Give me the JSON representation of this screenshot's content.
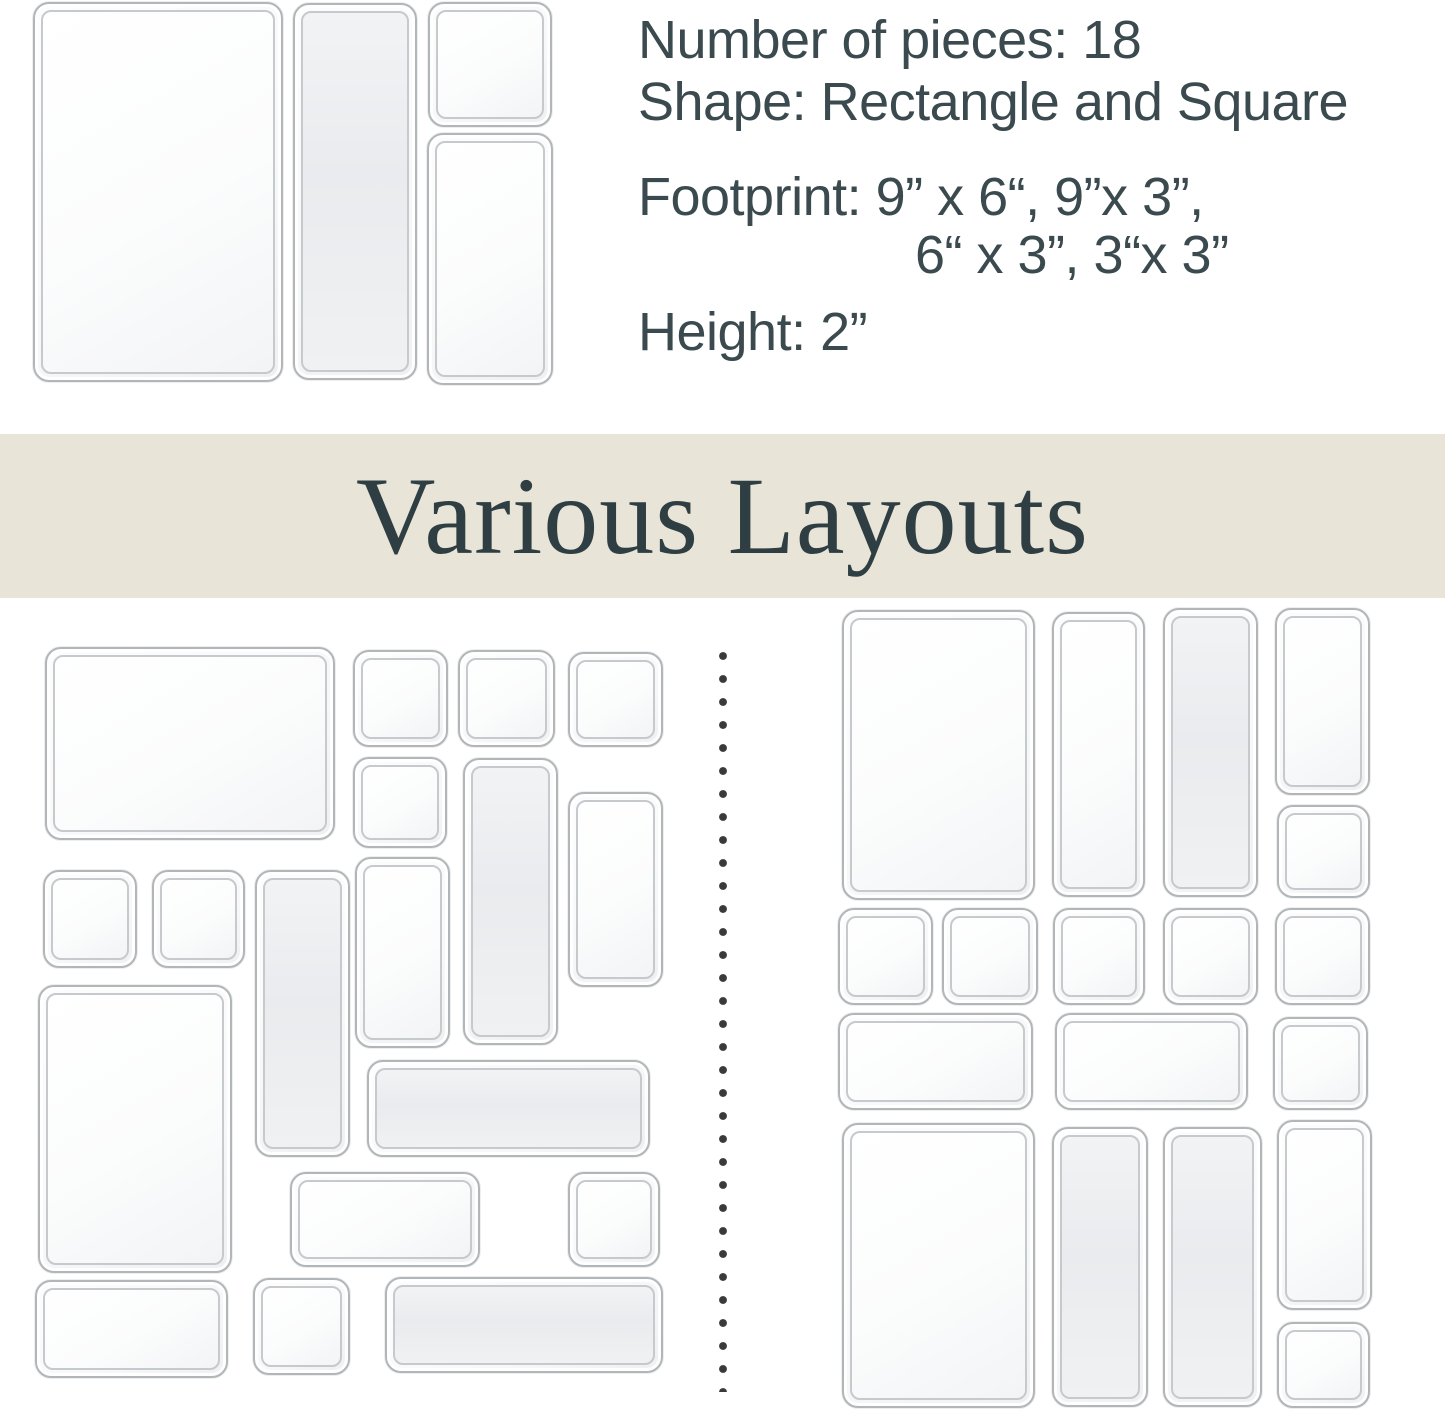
{
  "specs": {
    "number_of_pieces": "Number of pieces: 18",
    "shape": "Shape: Rectangle and Square",
    "footprint_line1": "Footprint: 9” x 6“, 9”x 3”,",
    "footprint_line2": "6“ x 3”, 3“x 3”",
    "height": "Height: 2”"
  },
  "banner": {
    "title": "Various Layouts"
  },
  "colors": {
    "page-bg": "#ffffff",
    "spec-text": "#3a4a4e",
    "banner-bg": "#e8e4d7",
    "banner-text": "#2e3e42",
    "tray-border": "#b2b6b9",
    "tray-inner-border": "#c6cacc",
    "divider-dot": "#3a3a3a"
  },
  "divider": {
    "dot_count": 33
  },
  "trays": {
    "photo": [
      {
        "size": "9x6",
        "x": 33,
        "y": 2,
        "w": 250,
        "h": 380,
        "shade": false
      },
      {
        "size": "9x3",
        "x": 293,
        "y": 3,
        "w": 124,
        "h": 377,
        "shade": true
      },
      {
        "size": "3x3",
        "x": 428,
        "y": 2,
        "w": 124,
        "h": 125,
        "shade": false
      },
      {
        "size": "6x3",
        "x": 427,
        "y": 133,
        "w": 126,
        "h": 252,
        "shade": false
      }
    ],
    "left_layout": [
      {
        "size": "9x6",
        "x": 45,
        "y": 647,
        "w": 290,
        "h": 193,
        "shade": false
      },
      {
        "size": "3x3",
        "x": 353,
        "y": 650,
        "w": 95,
        "h": 97,
        "shade": false
      },
      {
        "size": "3x3",
        "x": 458,
        "y": 650,
        "w": 97,
        "h": 97,
        "shade": false
      },
      {
        "size": "3x3",
        "x": 568,
        "y": 652,
        "w": 95,
        "h": 95,
        "shade": false
      },
      {
        "size": "3x3",
        "x": 353,
        "y": 757,
        "w": 94,
        "h": 91,
        "shade": false
      },
      {
        "size": "9x3",
        "x": 463,
        "y": 758,
        "w": 95,
        "h": 287,
        "shade": true
      },
      {
        "size": "6x3",
        "x": 568,
        "y": 792,
        "w": 95,
        "h": 195,
        "shade": false
      },
      {
        "size": "3x3",
        "x": 43,
        "y": 870,
        "w": 94,
        "h": 98,
        "shade": false
      },
      {
        "size": "3x3",
        "x": 152,
        "y": 870,
        "w": 93,
        "h": 98,
        "shade": false
      },
      {
        "size": "9x3",
        "x": 255,
        "y": 870,
        "w": 95,
        "h": 287,
        "shade": true
      },
      {
        "size": "6x3",
        "x": 355,
        "y": 857,
        "w": 95,
        "h": 191,
        "shade": false
      },
      {
        "size": "9x6",
        "x": 38,
        "y": 985,
        "w": 194,
        "h": 288,
        "shade": false
      },
      {
        "size": "9x3",
        "x": 367,
        "y": 1060,
        "w": 283,
        "h": 97,
        "shade": true
      },
      {
        "size": "6x3",
        "x": 290,
        "y": 1172,
        "w": 190,
        "h": 95,
        "shade": false
      },
      {
        "size": "3x3",
        "x": 568,
        "y": 1172,
        "w": 92,
        "h": 95,
        "shade": false
      },
      {
        "size": "6x3",
        "x": 35,
        "y": 1280,
        "w": 193,
        "h": 98,
        "shade": false
      },
      {
        "size": "3x3",
        "x": 253,
        "y": 1278,
        "w": 97,
        "h": 97,
        "shade": false
      },
      {
        "size": "9x3",
        "x": 385,
        "y": 1277,
        "w": 278,
        "h": 96,
        "shade": true
      }
    ],
    "right_layout": [
      {
        "size": "9x6",
        "x": 842,
        "y": 610,
        "w": 193,
        "h": 290,
        "shade": false
      },
      {
        "size": "3x3",
        "x": 838,
        "y": 908,
        "w": 95,
        "h": 97,
        "shade": false
      },
      {
        "size": "3x3",
        "x": 942,
        "y": 908,
        "w": 96,
        "h": 97,
        "shade": false
      },
      {
        "size": "6x3",
        "x": 838,
        "y": 1013,
        "w": 195,
        "h": 97,
        "shade": false
      },
      {
        "size": "9x6",
        "x": 842,
        "y": 1123,
        "w": 193,
        "h": 285,
        "shade": false
      },
      {
        "size": "9x3",
        "x": 1052,
        "y": 612,
        "w": 93,
        "h": 285,
        "shade": false
      },
      {
        "size": "3x3",
        "x": 1053,
        "y": 908,
        "w": 92,
        "h": 97,
        "shade": false
      },
      {
        "size": "6x3",
        "x": 1055,
        "y": 1013,
        "w": 193,
        "h": 97,
        "shade": false
      },
      {
        "size": "9x3",
        "x": 1052,
        "y": 1127,
        "w": 96,
        "h": 280,
        "shade": true
      },
      {
        "size": "9x3",
        "x": 1163,
        "y": 608,
        "w": 95,
        "h": 289,
        "shade": true
      },
      {
        "size": "3x3",
        "x": 1163,
        "y": 908,
        "w": 95,
        "h": 97,
        "shade": false
      },
      {
        "size": "9x3",
        "x": 1163,
        "y": 1127,
        "w": 99,
        "h": 280,
        "shade": true
      },
      {
        "size": "6x3",
        "x": 1275,
        "y": 608,
        "w": 95,
        "h": 187,
        "shade": false
      },
      {
        "size": "3x3",
        "x": 1277,
        "y": 805,
        "w": 93,
        "h": 93,
        "shade": false
      },
      {
        "size": "3x3",
        "x": 1275,
        "y": 908,
        "w": 95,
        "h": 97,
        "shade": false
      },
      {
        "size": "3x3",
        "x": 1273,
        "y": 1017,
        "w": 95,
        "h": 93,
        "shade": false
      },
      {
        "size": "6x3",
        "x": 1277,
        "y": 1120,
        "w": 95,
        "h": 190,
        "shade": false
      },
      {
        "size": "3x3",
        "x": 1277,
        "y": 1322,
        "w": 93,
        "h": 86,
        "shade": false
      }
    ]
  }
}
